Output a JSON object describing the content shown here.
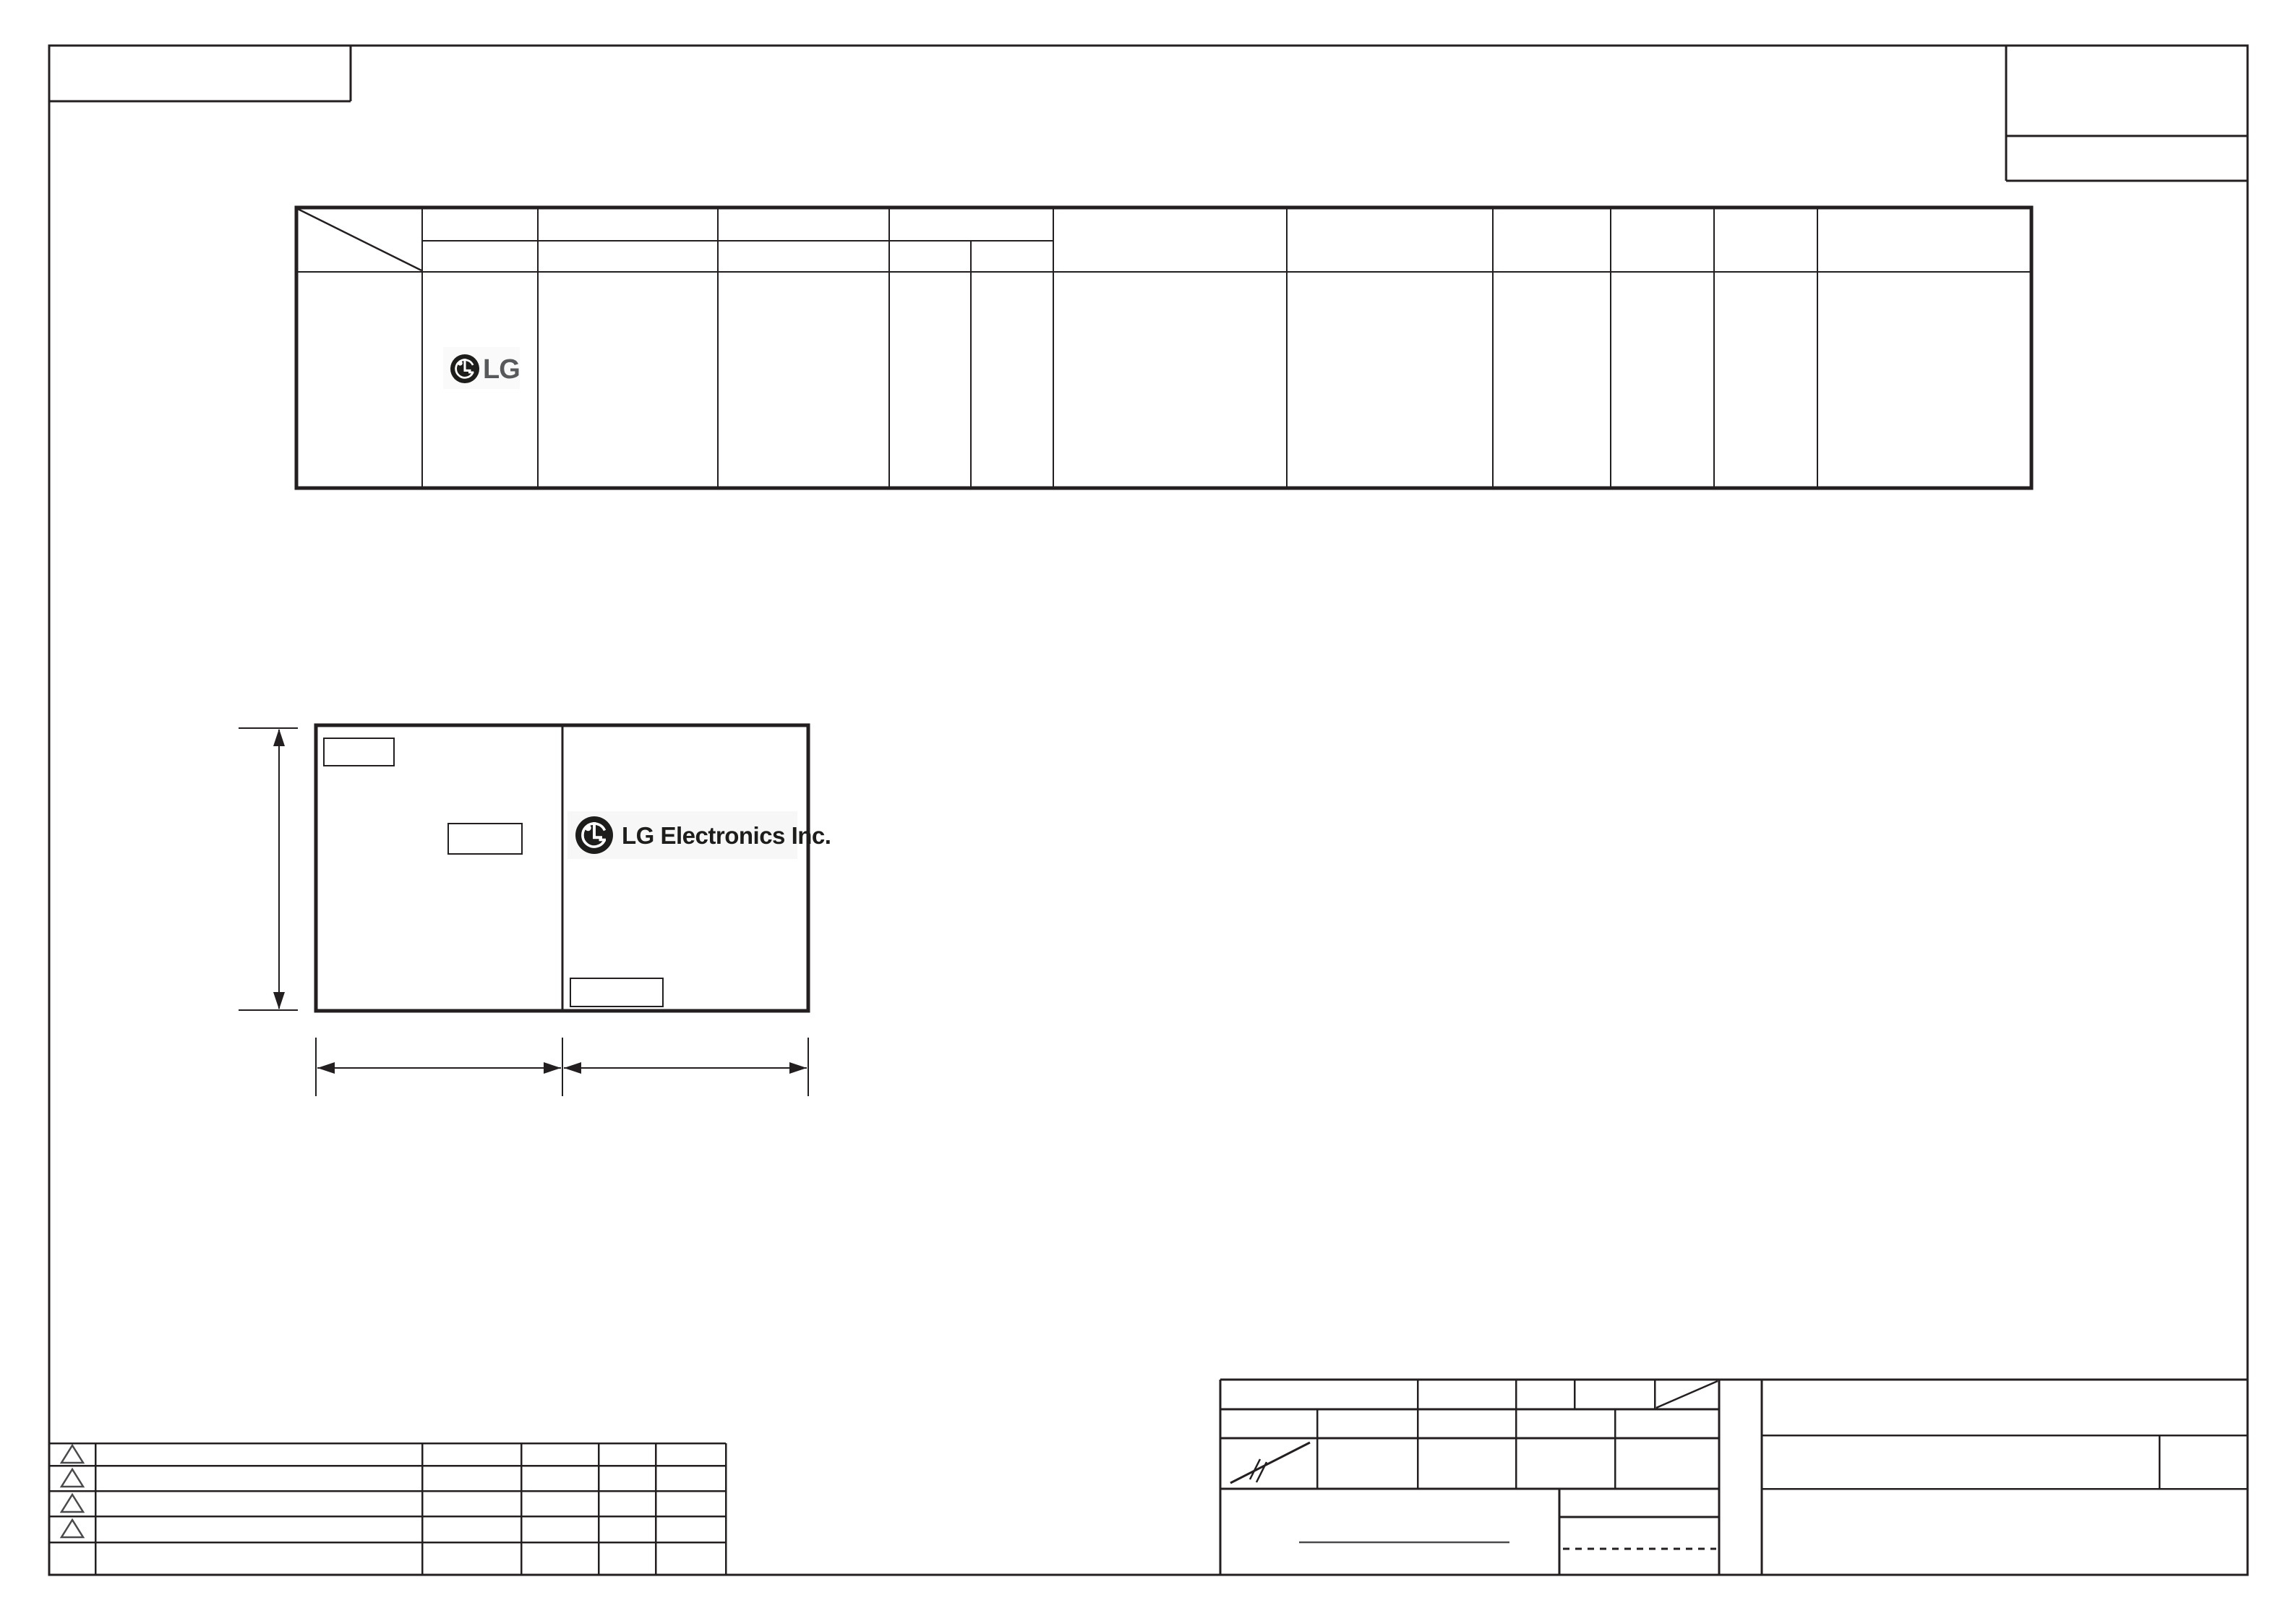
{
  "sheet": {
    "background_color": "#ffffff",
    "line_color": "#231f20",
    "accent_gray": "#4a4a4c"
  },
  "spec_table": {
    "logo": {
      "icon": "lg-emblem-icon",
      "text": "LG",
      "text_color": "#58595b"
    },
    "header_rows": 2,
    "body_rows": 1,
    "column_count": 12
  },
  "shipping_label": {
    "logo": {
      "icon": "lg-emblem-icon",
      "text": "LG Electronics Inc.",
      "text_color": "#1d1d1b"
    },
    "field_boxes": 3,
    "dimension_lines": [
      "height",
      "left-width",
      "right-width"
    ]
  },
  "revision_table": {
    "row_count": 5,
    "marker_icon": "revision-triangle-icon",
    "marker_count": 4
  },
  "title_block": {
    "symbols": [
      "scale-strike-icon",
      "corner-diagonal-icon"
    ],
    "signature_line": true,
    "dotted_line": true
  }
}
